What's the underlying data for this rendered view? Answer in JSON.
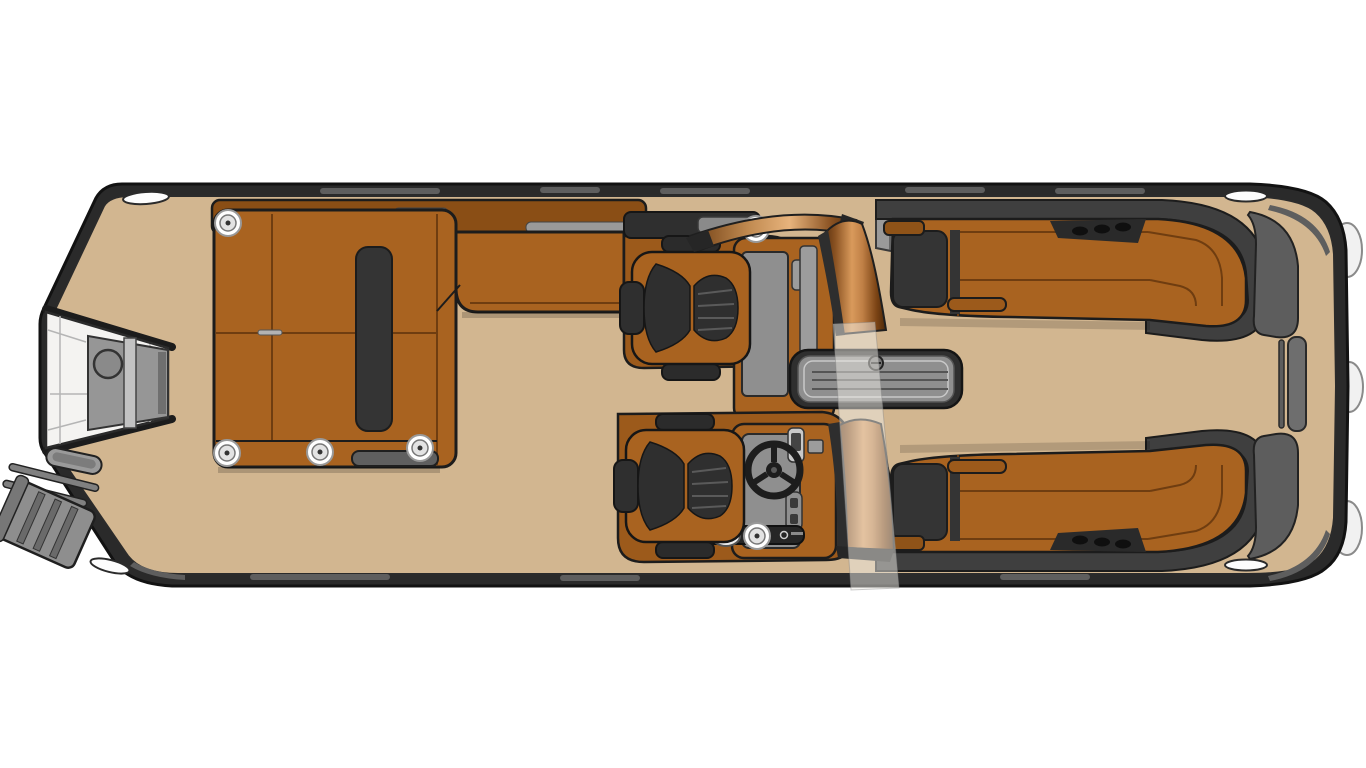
{
  "canvas": {
    "width": 1366,
    "height": 768,
    "background": "#ffffff",
    "description": "Top-down floor plan illustration of a pontoon boat; pointed bow with boarding gate and ladder at left, squared stern with swim platform at right"
  },
  "colors": {
    "deck": "#d2b690",
    "hull": "#2a2a2a",
    "hull_line": "#121212",
    "rail_highlight": "#5e5e5e",
    "seat_brown": "#a96320",
    "seat_brown_dark": "#9c5a1b",
    "backrest_brown": "#8a4e15",
    "seam_brown": "#6f3d10",
    "cushion_dark": "#2f2f2f",
    "band_dark": "#3f3f3f",
    "panel_gray": "#8f8f8f",
    "wedge_gray": "#5d5d5d",
    "gate_white": "#f4f3f1",
    "copper_light": "#d99a5b",
    "copper_dark": "#5a300e",
    "glass_tint": "rgba(238,235,229,0.5)",
    "cup_white": "#ffffff"
  },
  "parts": {
    "hull": "Hull with rub rail",
    "deck": "Deck flooring",
    "bow_gate": "Bow boarding gate",
    "bow_ladder": "Bow boarding ladder",
    "bow_lounge": "L-shaped bow lounge",
    "bow_lounge_backrest": "Bow lounge backrest",
    "captain_chair_port": "Swivel chair (port side)",
    "captain_chair_helm": "Swivel chair at helm",
    "companion_console": "Companion console",
    "helm_console": "Helm console",
    "steering_wheel": "Steering wheel",
    "throttle": "Throttle control",
    "windshield": "Walk-through windshield",
    "glass_gate": "Clear walk-through glass panel",
    "floor_hatch": "In-floor storage hatch",
    "stern_lounge_port": "Stern chaise lounge (port)",
    "stern_lounge_starboard": "Stern chaise lounge (starboard)",
    "stern_gate": "Stern boarding gate",
    "side_gate_floor": "Side gate floor pad",
    "fender": "Fender bumper",
    "cleat": "Mooring cleat",
    "cup_holder": "Cup holder",
    "drink": "Drink cup",
    "step_tray": "Step tray"
  }
}
